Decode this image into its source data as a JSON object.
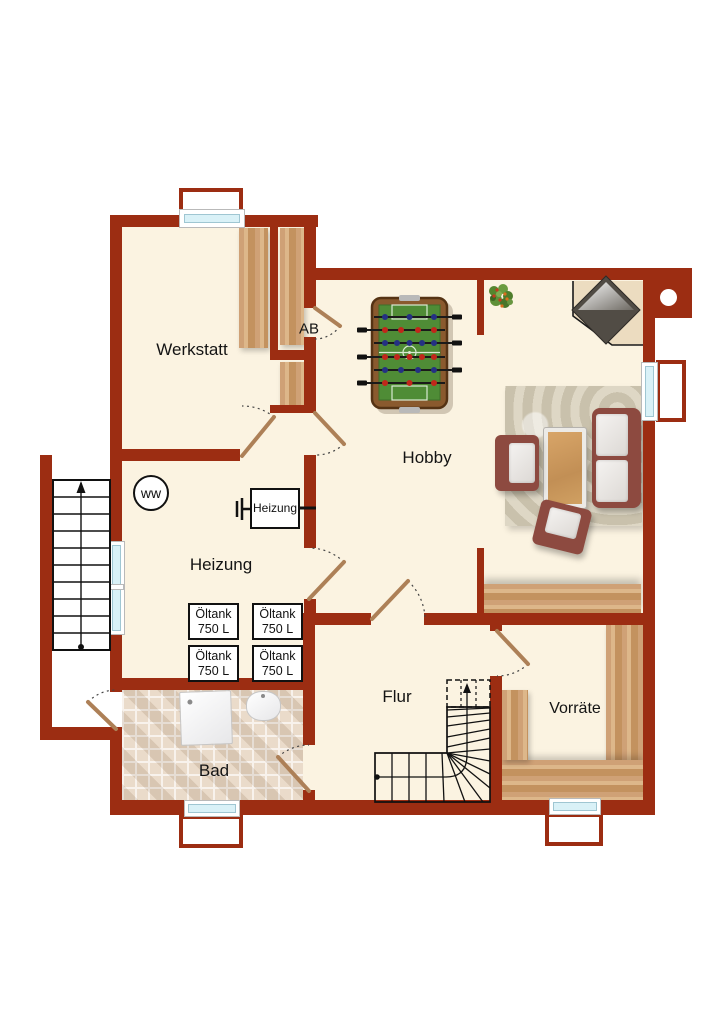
{
  "floorplan": {
    "type": "basement floor plan",
    "language": "de",
    "rooms": {
      "werkstatt": {
        "label": "Werkstatt"
      },
      "ab": {
        "label": "AB"
      },
      "hobby": {
        "label": "Hobby"
      },
      "heizung": {
        "label": "Heizung"
      },
      "bad": {
        "label": "Bad"
      },
      "flur": {
        "label": "Flur"
      },
      "vorraete": {
        "label": "Vorräte"
      }
    },
    "equipment": {
      "water_heater": {
        "label": "ww"
      },
      "furnace": {
        "label": "Heizung"
      },
      "tanks": [
        {
          "name": "Öltank",
          "capacity": "750 L"
        },
        {
          "name": "Öltank",
          "capacity": "750 L"
        },
        {
          "name": "Öltank",
          "capacity": "750 L"
        },
        {
          "name": "Öltank",
          "capacity": "750 L"
        }
      ]
    },
    "colors": {
      "wall": "#9c2d12",
      "floor": "#fbf3e1",
      "wood": "#c99b6d",
      "tile": "#ecdfd0",
      "glass": "#d9f1f7",
      "sofa": "#8d4a40",
      "foosball_field": "#4f8c36"
    }
  }
}
